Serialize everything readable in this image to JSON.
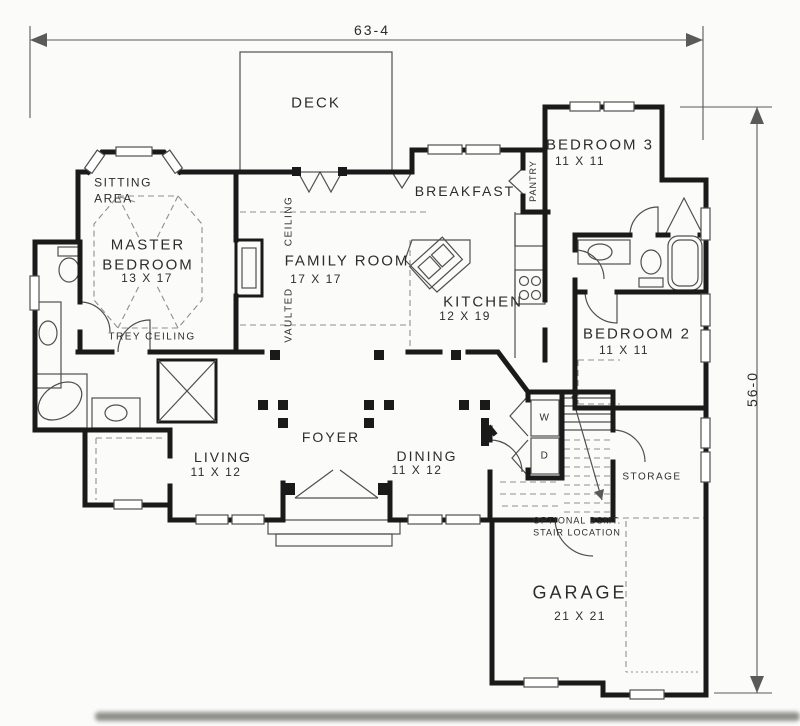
{
  "plan": {
    "type": "floor-plan",
    "dimension_width": "63-4",
    "dimension_height": "56-0"
  },
  "rooms": {
    "deck": {
      "name": "DECK"
    },
    "sitting_area": {
      "name": "SITTING\nAREA"
    },
    "master_bedroom": {
      "name": "MASTER\nBEDROOM",
      "size": "13 X 17"
    },
    "family_room": {
      "name": "FAMILY ROOM",
      "size": "17 X 17"
    },
    "breakfast": {
      "name": "BREAKFAST"
    },
    "pantry": {
      "name": "PANTRY"
    },
    "kitchen": {
      "name": "KITCHEN",
      "size": "12 X 19"
    },
    "bedroom3": {
      "name": "BEDROOM 3",
      "size": "11 X 11"
    },
    "bedroom2": {
      "name": "BEDROOM 2",
      "size": "11 X 11"
    },
    "living": {
      "name": "LIVING",
      "size": "11 X 12"
    },
    "dining": {
      "name": "DINING",
      "size": "11 X 12"
    },
    "foyer": {
      "name": "FOYER"
    },
    "storage": {
      "name": "STORAGE"
    },
    "garage": {
      "name": "GARAGE",
      "size": "21 X 21"
    }
  },
  "annotations": {
    "trey_ceiling": "TREY CEILING",
    "vaulted_word": "VAULTED",
    "ceiling_word": "CEILING",
    "washer": "W",
    "dryer": "D",
    "stair_note": "OPTIONAL BSMT.\nSTAIR LOCATION"
  },
  "colors": {
    "wall": "#1a1a1a",
    "line": "#4f4f4f",
    "dashed": "#8f8f8f",
    "paper": "#fbfbfa",
    "text": "#2d2d2d",
    "dim": "#5a5a5a"
  }
}
